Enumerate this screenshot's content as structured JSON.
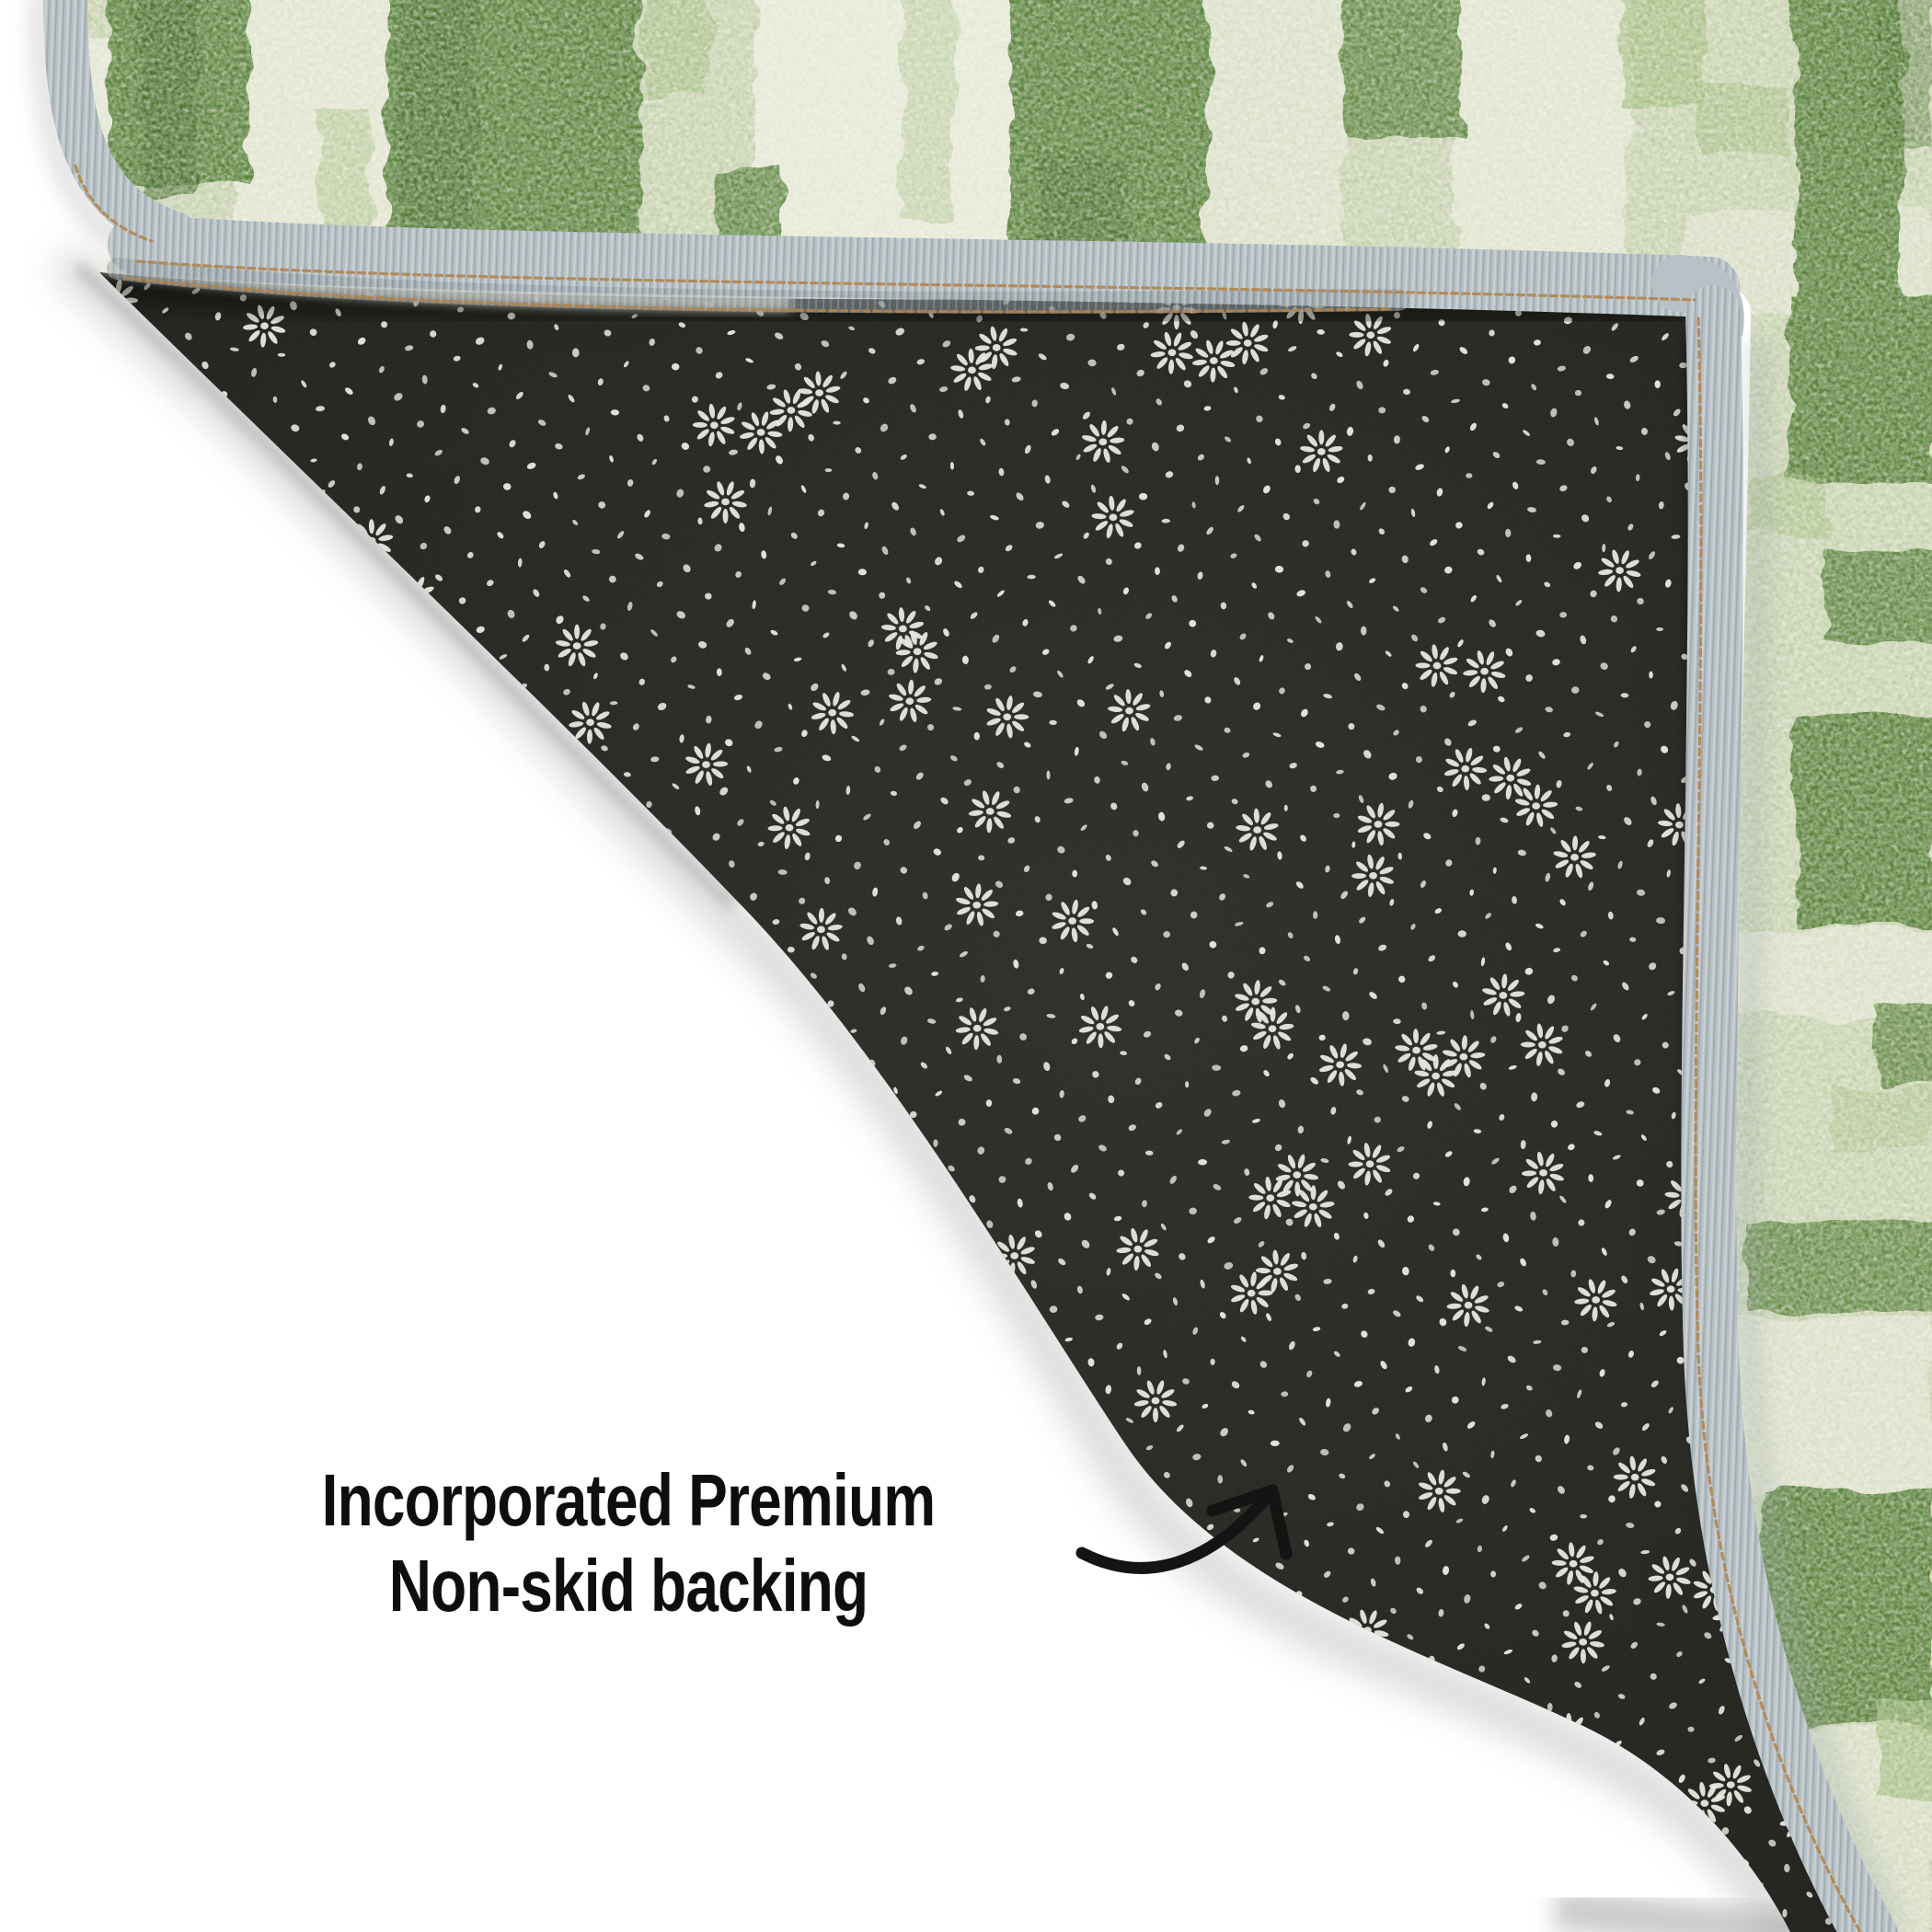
{
  "caption": {
    "line1": "Incorporated Premium",
    "line2": "Non-skid backing"
  },
  "icons": {
    "arrow": "curved-arrow-up-right"
  },
  "palette": {
    "bg": "#ffffff",
    "sage": "#d8ddc2",
    "sage_pale": "#e8e9da",
    "green_dark": "#5d8440",
    "green_deep": "#4b7132",
    "green_mid": "#9cb877",
    "binding": "#b7c1c6",
    "binding_shadow": "#96a1a6",
    "stitch": "#b3854e",
    "pile": "#ece9da",
    "backing": "#1d1e19",
    "backing_hi": "#2c2d26",
    "dot": "#e9e8e0",
    "shadow": "#9a9a9a",
    "text": "#0e0e0e",
    "arrow": "#141414"
  }
}
